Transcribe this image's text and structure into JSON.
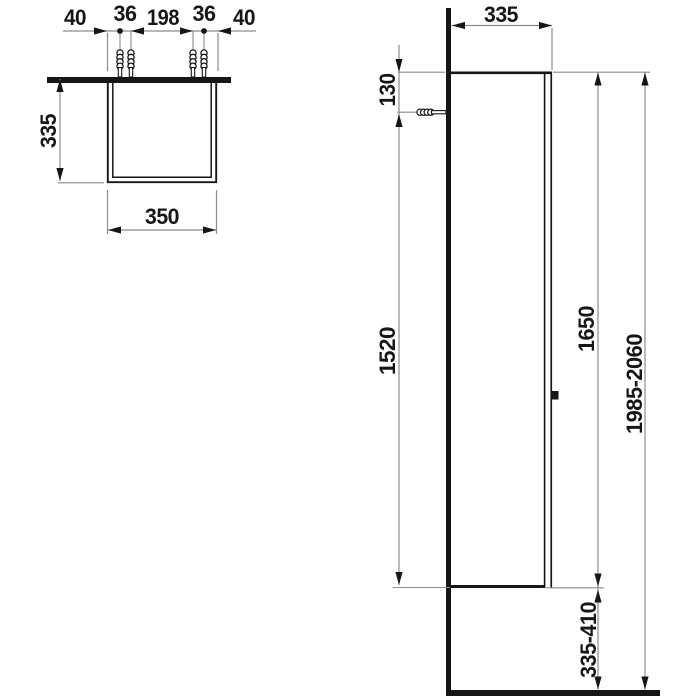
{
  "top_view": {
    "spacing_left_edge": "40",
    "spacing_pair_left": "36",
    "spacing_center": "198",
    "spacing_pair_right": "36",
    "spacing_right_edge": "40",
    "depth": "335",
    "width": "350"
  },
  "side_view": {
    "depth": "335",
    "fixing_from_top": "130",
    "fixing_to_bottom": "1520",
    "cabinet_height": "1650",
    "mounting_height_range": "1985-2060",
    "floor_clearance_range": "335-410"
  },
  "colors": {
    "background": "#ffffff",
    "outline": "#161616",
    "dimension_line": "#8c8c8c"
  }
}
